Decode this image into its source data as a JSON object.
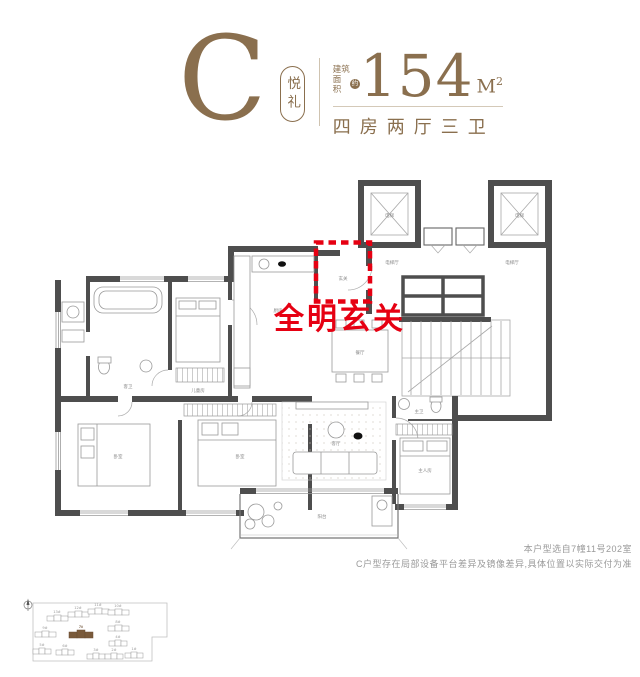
{
  "header": {
    "type_letter": "C",
    "type_name": "悦礼",
    "area_label_line1": "建筑",
    "area_label_line2": "面积",
    "area_approx_badge": "约",
    "area_value": "154",
    "area_unit": "M",
    "area_unit_exp": "2",
    "layout_summary": "四房两厅三卫",
    "brand_color": "#8a6f4e"
  },
  "annotation": {
    "text": "全明玄关",
    "color": "#e60012"
  },
  "plan": {
    "wall_color": "#4e4e4e",
    "rooms": {
      "entry": "玄关",
      "kitchen": "厨房",
      "dining": "餐厅",
      "living": "客厅",
      "balcony": "阳台",
      "kids_room": "儿童房",
      "bedroom_left": "卧室",
      "bedroom_mid": "卧室",
      "master": "主人房",
      "bath": "客卫",
      "master_bath": "主卫"
    },
    "core": {
      "elevator": "电梯",
      "elevator_hall": "电梯厅"
    }
  },
  "disclaimer": {
    "line1": "本户型选自7幢11号202室",
    "line2": "C户型存在局部设备平台差异及镜像差异,具体位置以实际交付为准"
  },
  "siteplan": {
    "highlight_color": "#7a5a3a",
    "buildings": [
      {
        "label": "13#"
      },
      {
        "label": "12#"
      },
      {
        "label": "11#"
      },
      {
        "label": "10#"
      },
      {
        "label": "9#"
      },
      {
        "label": "7#",
        "highlighted": true
      },
      {
        "label": "8#"
      },
      {
        "label": "5#"
      },
      {
        "label": "6#"
      },
      {
        "label": "4#"
      },
      {
        "label": "3#"
      },
      {
        "label": "2#"
      },
      {
        "label": "1#"
      }
    ]
  }
}
